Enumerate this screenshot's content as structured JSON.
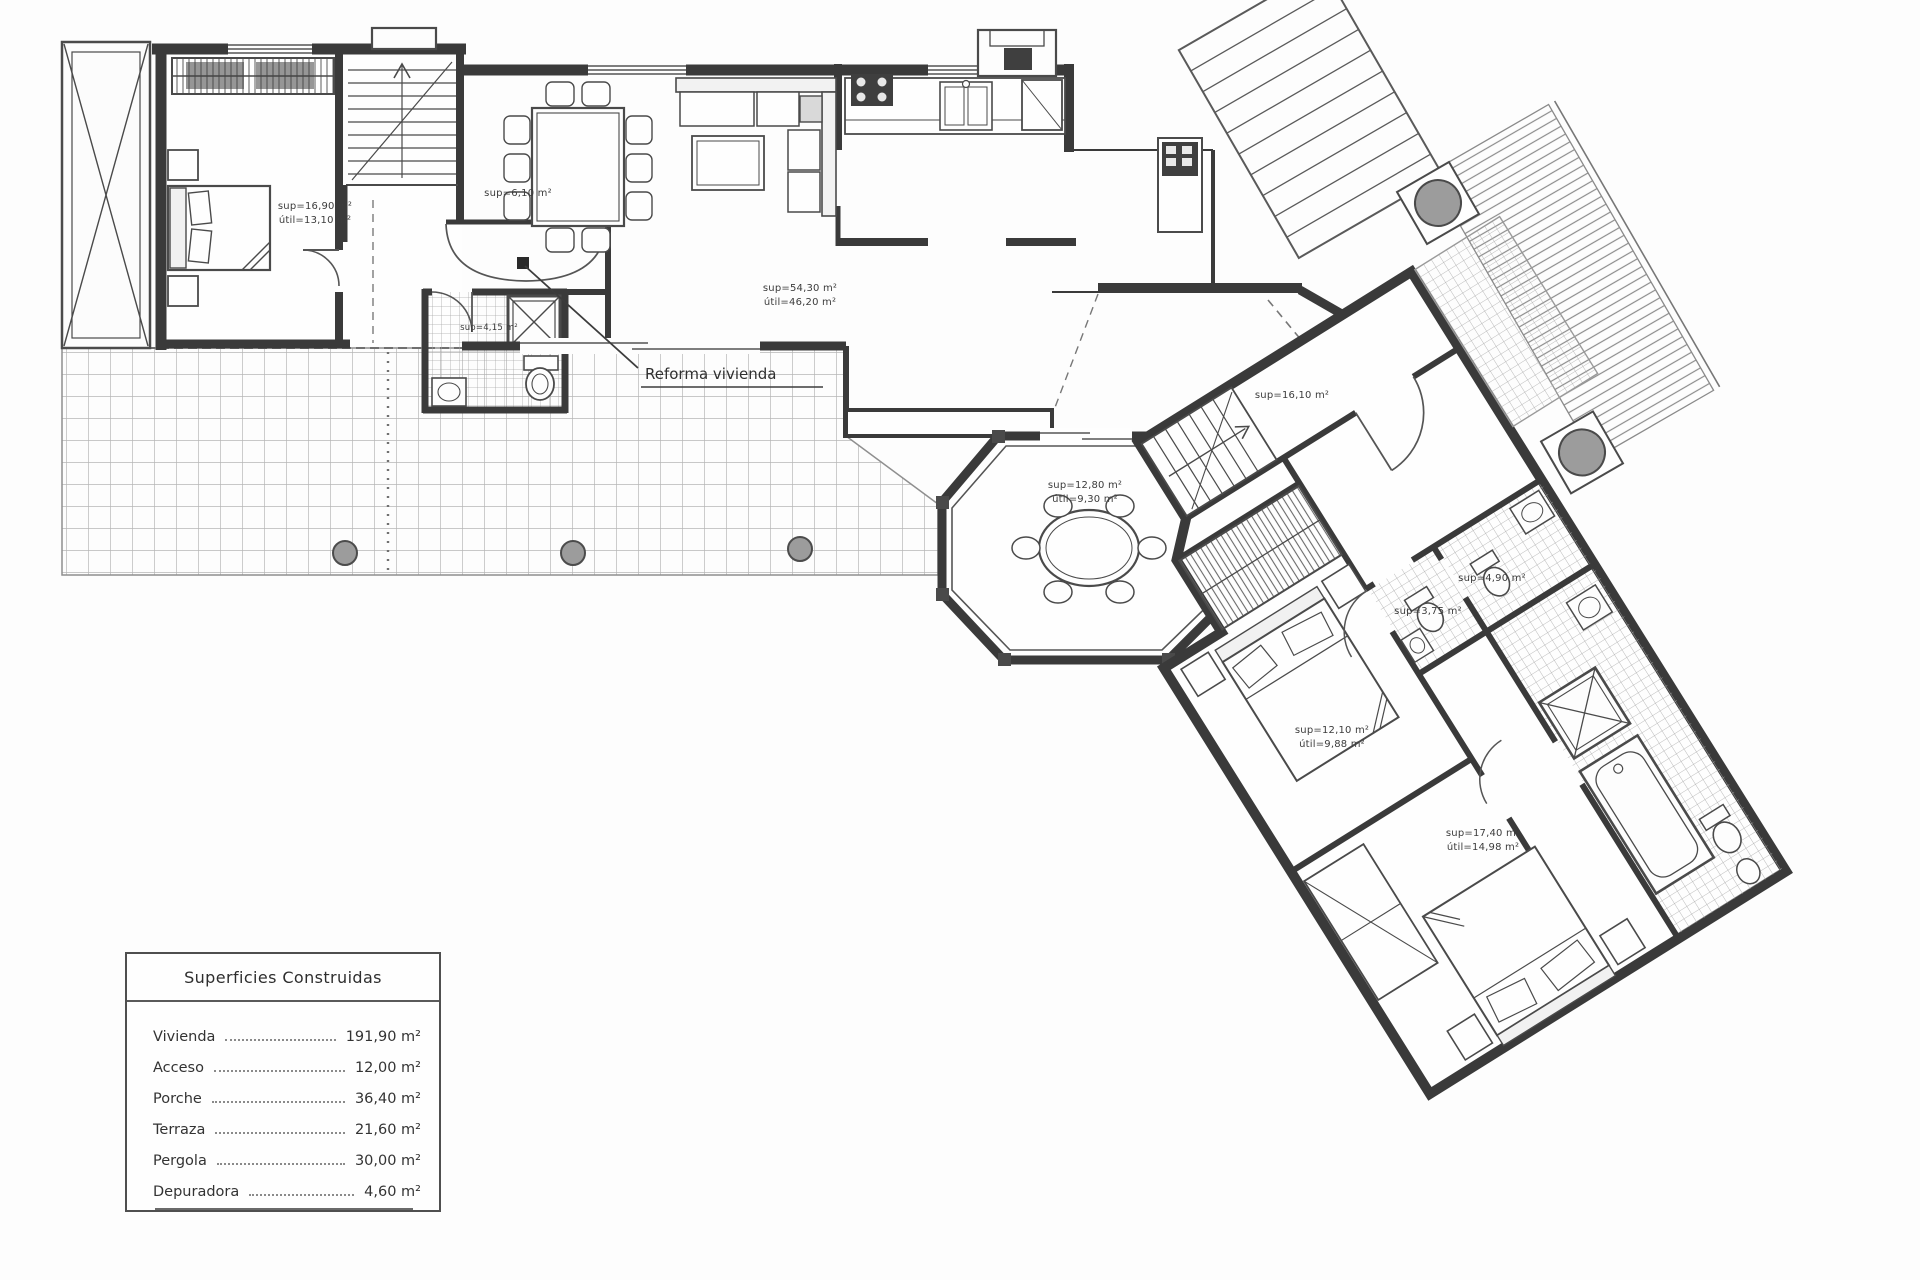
{
  "annotation": {
    "reform_label": "Reforma vivienda"
  },
  "legend": {
    "title": "Superficies Construidas",
    "rows": [
      {
        "label": "Vivienda",
        "value": "191,90 m²"
      },
      {
        "label": "Acceso",
        "value": "12,00 m²"
      },
      {
        "label": "Porche",
        "value": "36,40 m²"
      },
      {
        "label": "Terraza",
        "value": "21,60 m²"
      },
      {
        "label": "Pergola",
        "value": "30,00 m²"
      },
      {
        "label": "Depuradora",
        "value": "4,60 m²"
      }
    ]
  },
  "rooms": {
    "bedroom1": {
      "line1": "sup=16,90 m²",
      "line2": "útil=13,10 m²"
    },
    "hall": {
      "line1": "sup=6,10 m²"
    },
    "bath1": {
      "line1": "sup=4,15 m²"
    },
    "living": {
      "line1": "sup=54,30 m²",
      "line2": "útil=46,20 m²"
    },
    "gazebo": {
      "line1": "sup=12,80 m²",
      "line2": "útil=9,30 m²"
    },
    "hallway2": {
      "line1": "sup=16,10 m²"
    },
    "bath2": {
      "line1": "sup=4,90 m²"
    },
    "wc": {
      "line1": "sup=3,75 m²"
    },
    "bedroom2": {
      "line1": "sup=12,10 m²",
      "line2": "útil=9,88 m²"
    },
    "bedroom3": {
      "line1": "sup=17,40 m²",
      "line2": "útil=14,98 m²"
    }
  },
  "colors": {
    "wall": "#3a3a3a",
    "line": "#555555",
    "hatch": "#9a9a9a",
    "grid": "#b6b6b6",
    "planter": "#9c9c9c",
    "paper": "#fdfdfd"
  }
}
